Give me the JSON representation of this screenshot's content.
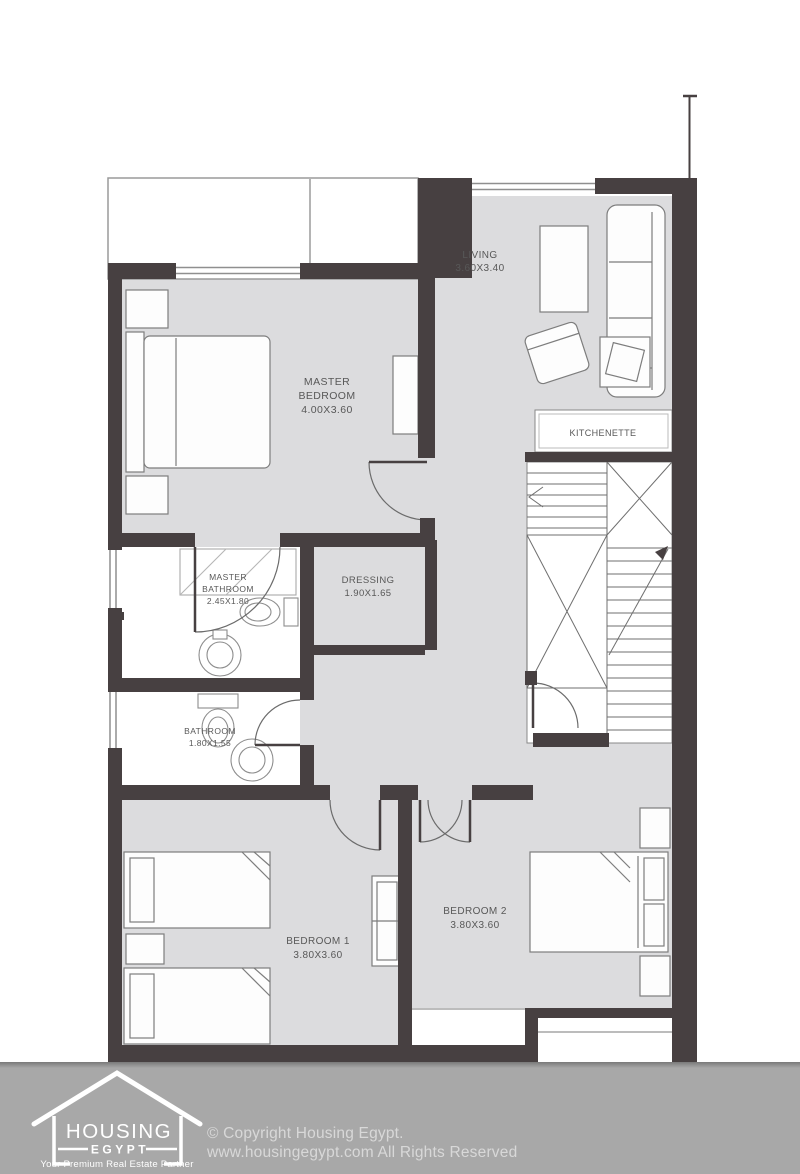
{
  "rooms": {
    "living": {
      "name": "LIVING",
      "dims": "3.60X3.40"
    },
    "master_bedroom": {
      "line1": "MASTER",
      "line2": "BEDROOM",
      "dims": "4.00X3.60"
    },
    "kitchenette": {
      "name": "KITCHENETTE"
    },
    "master_bathroom": {
      "line1": "MASTER",
      "line2": "BATHROOM",
      "dims": "2.45X1.80"
    },
    "dressing": {
      "name": "DRESSING",
      "dims": "1.90X1.65"
    },
    "bathroom": {
      "name": "BATHROOM",
      "dims": "1.80X1.55"
    },
    "bedroom1": {
      "name": "BEDROOM 1",
      "dims": "3.80X3.60"
    },
    "bedroom2": {
      "name": "BEDROOM 2",
      "dims": "3.80X3.60"
    }
  },
  "footer": {
    "logo": {
      "name": "HOUSING",
      "sub": "EGYPT",
      "tagline": "Your Premium Real Estate Partner"
    },
    "copyright_line1": "© Copyright Housing Egypt.",
    "copyright_line2": "www.housingegypt.com All Rights Reserved"
  },
  "colors": {
    "wall": "#474041",
    "room_fill": "#dcdcde",
    "furniture_line": "#7d7d7d",
    "footer_bg": "#a8a8a8",
    "label_text": "#585858",
    "logo": "#ffffff"
  }
}
